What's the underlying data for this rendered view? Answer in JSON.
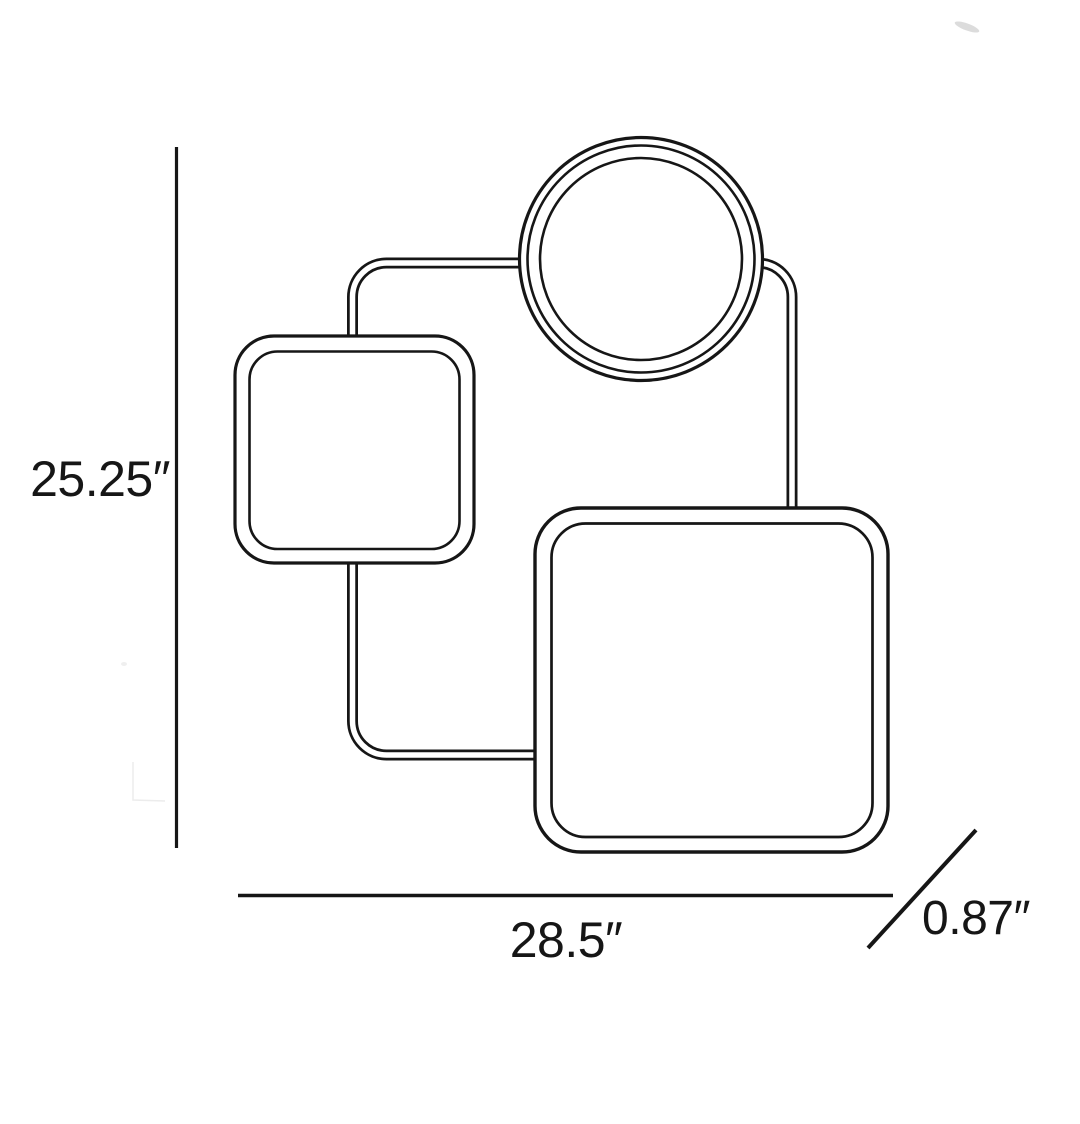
{
  "page": {
    "background": "#ffffff",
    "line_color": "#161616"
  },
  "drawing": {
    "kind": "product-dimension-line-drawing",
    "parts": [
      "frame-tube",
      "circular-shade",
      "small-square-shade",
      "large-square-shade"
    ]
  },
  "labels": {
    "height": "25.25″",
    "width": "28.5″",
    "depth": "0.87″"
  }
}
